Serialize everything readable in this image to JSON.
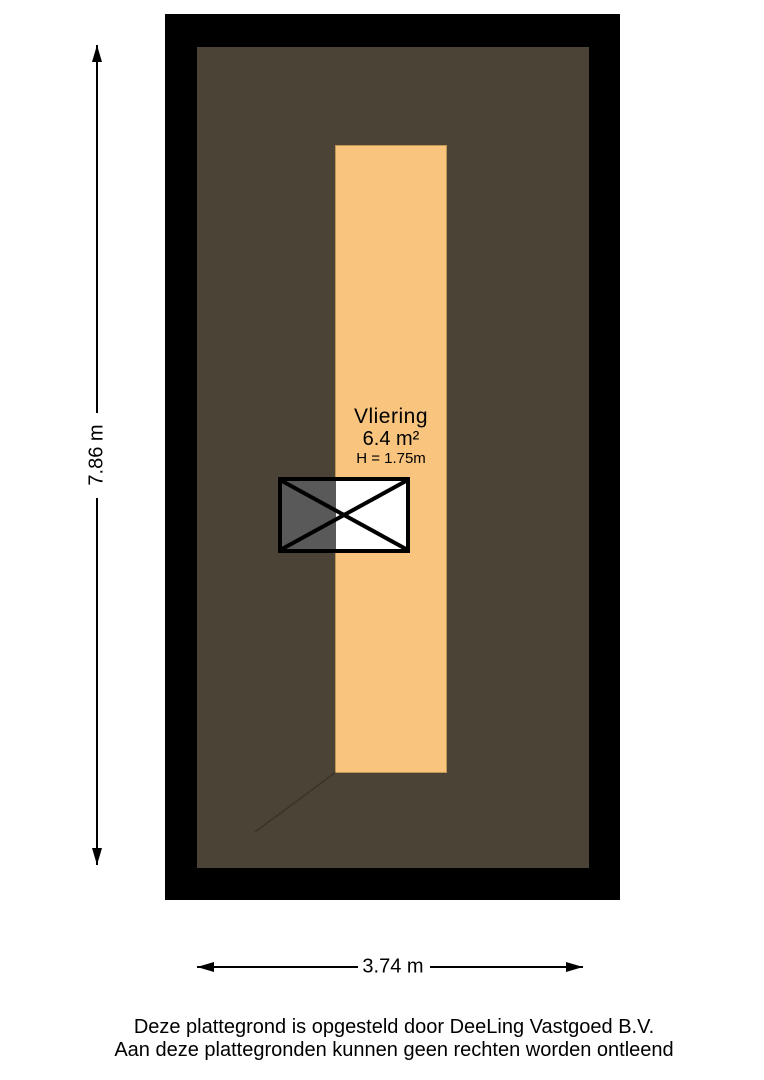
{
  "floorplan": {
    "room_label": "Vliering",
    "area_label": "6.4 m²",
    "height_label": "H = 1.75m",
    "colors": {
      "wall_outline": "#000000",
      "roof_area": "#4A4336",
      "attic_floor": "#F9C57E",
      "hatch_gray": "#595959",
      "hatch_white": "#FFFFFF"
    }
  },
  "dimensions": {
    "vertical_label": "7.86 m",
    "horizontal_label": "3.74 m"
  },
  "footer": {
    "line1": "Deze plattegrond is opgesteld door DeeLing Vastgoed B.V.",
    "line2": "Aan deze plattegronden kunnen geen rechten worden ontleend"
  }
}
